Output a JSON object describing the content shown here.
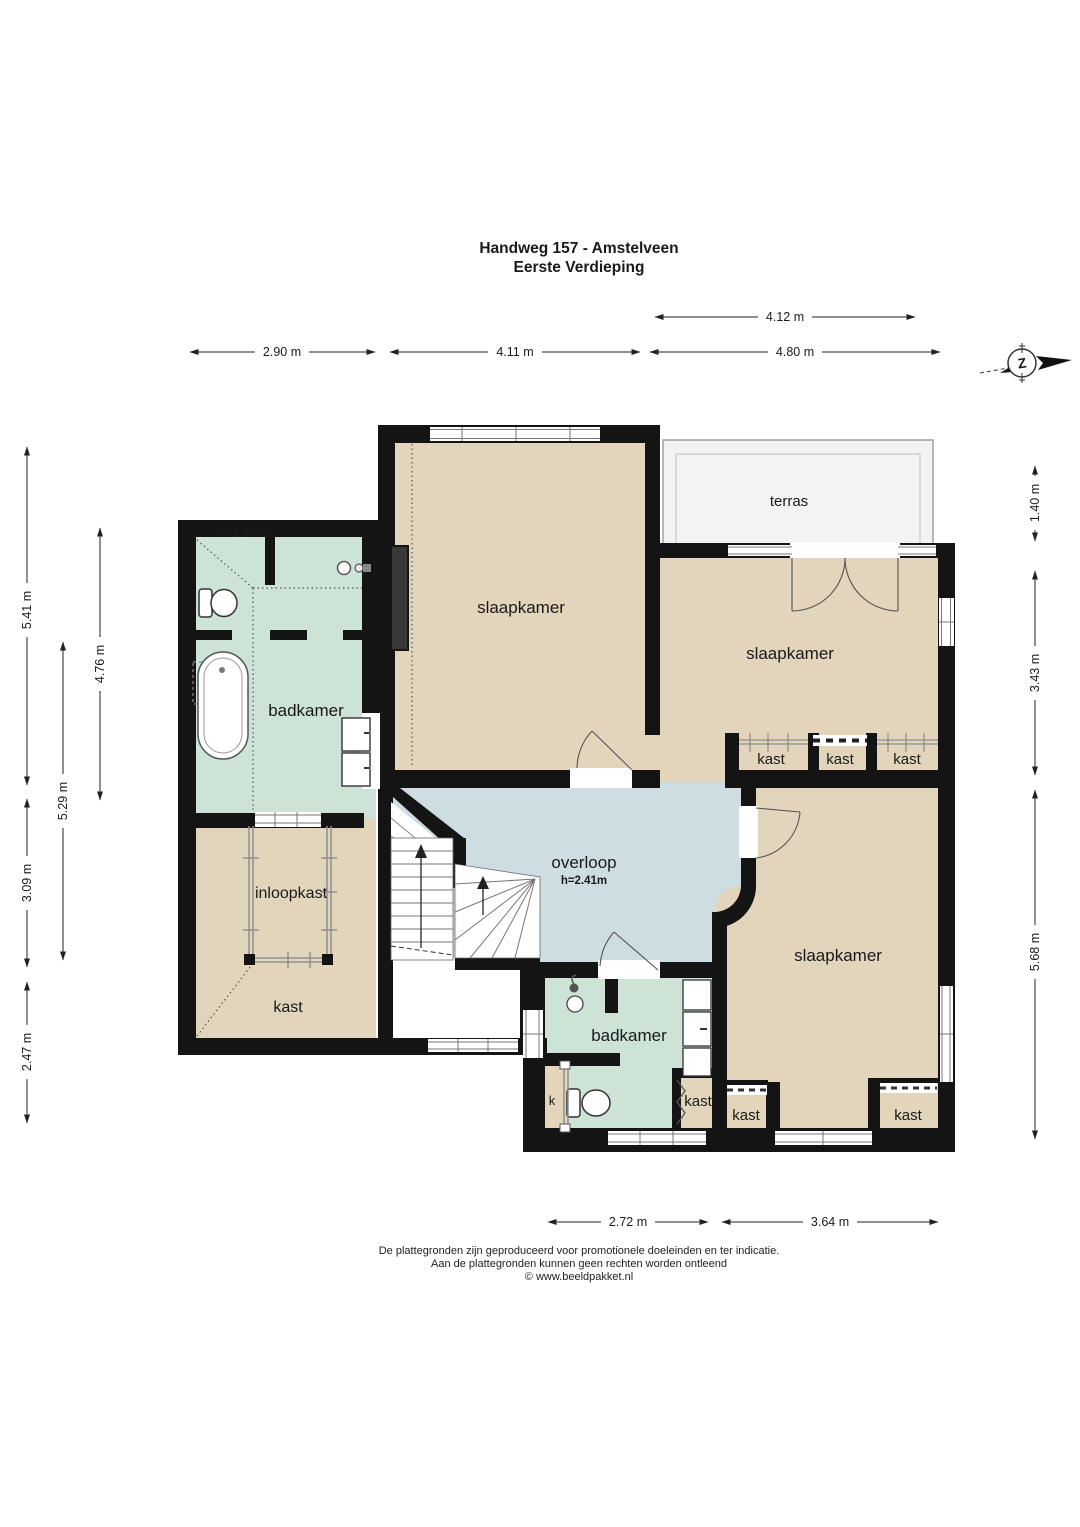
{
  "title": {
    "line1": "Handweg 157 - Amstelveen",
    "line2": "Eerste Verdieping"
  },
  "labels": {
    "terras": "terras",
    "slaapkamer_n": "slaapkamer",
    "slaapkamer_ne": "slaapkamer",
    "slaapkamer_se": "slaapkamer",
    "badkamer_nw": "badkamer",
    "badkamer_nw_height": "h=1.50m",
    "badkamer_s": "badkamer",
    "overloop": "overloop",
    "overloop_height": "h=2.41m",
    "inloopkast": "inloopkast",
    "kast_nw": "kast",
    "kast_row_1": "kast",
    "kast_row_2": "kast",
    "kast_row_3": "kast",
    "kast_s": "kast",
    "kast_sw": "kast",
    "kast_se": "kast",
    "k_closet": "k"
  },
  "dimensions": {
    "top": [
      "4.12 m",
      "2.90 m",
      "4.11 m",
      "4.80 m"
    ],
    "bottom": [
      "2.72 m",
      "3.64 m"
    ],
    "left": [
      "5.41 m",
      "4.76 m",
      "5.29 m",
      "3.09 m",
      "2.47 m"
    ],
    "right": [
      "1.40 m",
      "3.43 m",
      "5.68 m"
    ]
  },
  "compass": {
    "letter": "Z"
  },
  "footer": [
    "De plattegronden zijn geproduceerd voor promotionele doeleinden en ter indicatie.",
    "Aan de plattegronden kunnen geen rechten worden ontleend",
    "© www.beeldpakket.nl"
  ],
  "colors": {
    "wall": "#141414",
    "floor_tan": "#e2d5bb",
    "floor_green": "#cde3d6",
    "floor_blue": "#cedde2",
    "terras_fill": "#f3f3f3"
  }
}
